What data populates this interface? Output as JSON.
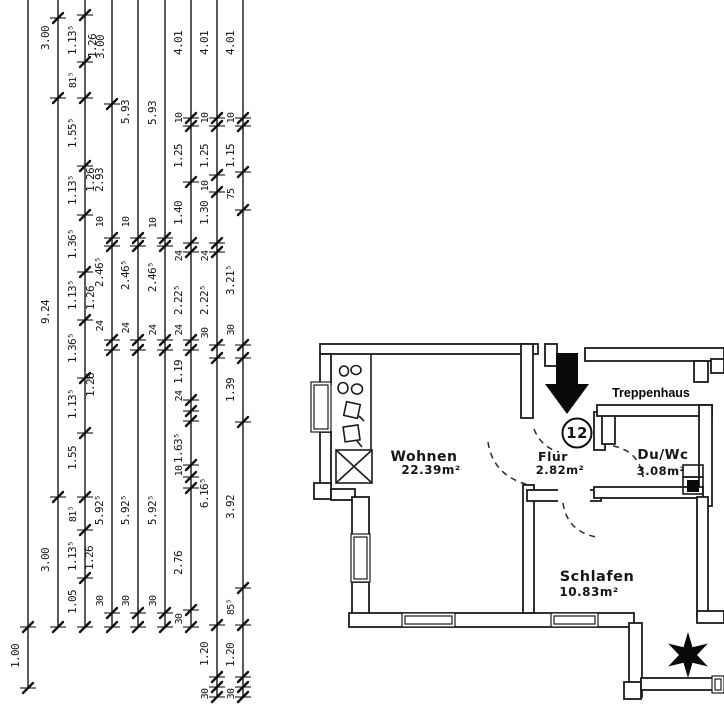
{
  "colors": {
    "ink": "#1b1b1b",
    "paper": "#ffffff"
  },
  "dimension_block": {
    "chains": [
      {
        "x": 28,
        "y1": 0,
        "y2": 688,
        "ticks": [
          627,
          688
        ],
        "labels": [
          {
            "t": "1.00",
            "y": 656
          }
        ]
      },
      {
        "x": 58,
        "y1": 0,
        "y2": 627,
        "ticks": [
          18,
          98,
          497,
          627
        ],
        "labels": [
          {
            "t": "3.00",
            "y": 38
          },
          {
            "t": "9.24",
            "y": 312
          },
          {
            "t": "3.00",
            "y": 560
          }
        ]
      },
      {
        "x": 85,
        "y1": 0,
        "y2": 627,
        "ticks": [
          15,
          62,
          98,
          166,
          215,
          272,
          320,
          378,
          433,
          497,
          530,
          578,
          627
        ],
        "labels": [
          {
            "t": "1.13⁵",
            "y": 40
          },
          {
            "t": "81⁵",
            "y": 80
          },
          {
            "t": "1.55⁵",
            "y": 133
          },
          {
            "t": "1.13⁵",
            "y": 190
          },
          {
            "t": "1.36⁵",
            "y": 244
          },
          {
            "t": "1.13⁵",
            "y": 295
          },
          {
            "t": "1.36⁵",
            "y": 348
          },
          {
            "t": "1.13⁵",
            "y": 404
          },
          {
            "t": "1.55",
            "y": 458
          },
          {
            "t": "81⁵",
            "y": 514
          },
          {
            "t": "1.13⁵",
            "y": 556
          },
          {
            "t": "1.05",
            "y": 602
          }
        ]
      },
      {
        "x": 112,
        "y1": 0,
        "y2": 627,
        "ticks": [
          104,
          238,
          246,
          340,
          350,
          613,
          627
        ],
        "labels": [
          {
            "t": "2.93",
            "y": 180
          },
          {
            "t": "10",
            "y": 222
          },
          {
            "t": "2.46⁵",
            "y": 272
          },
          {
            "t": "24",
            "y": 326
          },
          {
            "t": "5.92⁵",
            "y": 510
          },
          {
            "t": "30",
            "y": 601
          }
        ]
      },
      {
        "x": 138,
        "y1": 0,
        "y2": 627,
        "ticks": [
          238,
          246,
          340,
          350,
          613,
          627
        ],
        "labels": [
          {
            "t": "5.93",
            "y": 112
          },
          {
            "t": "10",
            "y": 222
          },
          {
            "t": "2.46⁵",
            "y": 275
          },
          {
            "t": "24",
            "y": 328
          },
          {
            "t": "5.92⁵",
            "y": 510
          },
          {
            "t": "30",
            "y": 601
          }
        ]
      },
      {
        "x": 165,
        "y1": 0,
        "y2": 627,
        "ticks": [
          238,
          246,
          340,
          350,
          613,
          627
        ],
        "labels": [
          {
            "t": "5.93",
            "y": 113
          },
          {
            "t": "10",
            "y": 223
          },
          {
            "t": "2.46⁵",
            "y": 277
          },
          {
            "t": "24",
            "y": 330
          },
          {
            "t": "5.92⁵",
            "y": 510
          },
          {
            "t": "30",
            "y": 601
          }
        ]
      },
      {
        "x": 191,
        "y1": 0,
        "y2": 627,
        "ticks": [
          118,
          126,
          182,
          243,
          252,
          340,
          350,
          400,
          411,
          421,
          465,
          477,
          488,
          610,
          627
        ],
        "labels": [
          {
            "t": "4.01",
            "y": 43
          },
          {
            "t": "10",
            "y": 118
          },
          {
            "t": "1.25",
            "y": 156
          },
          {
            "t": "1.40",
            "y": 213
          },
          {
            "t": "24",
            "y": 256
          },
          {
            "t": "2.22⁵",
            "y": 300
          },
          {
            "t": "24",
            "y": 330
          },
          {
            "t": "1.19",
            "y": 372
          },
          {
            "t": "24",
            "y": 396
          },
          {
            "t": "1.63⁵",
            "y": 448
          },
          {
            "t": "10",
            "y": 471
          },
          {
            "t": "2.76",
            "y": 563
          },
          {
            "t": "30",
            "y": 619
          }
        ]
      },
      {
        "x": 217,
        "y1": 0,
        "y2": 697,
        "ticks": [
          118,
          126,
          175,
          192,
          243,
          252,
          345,
          358,
          625,
          677,
          687,
          697
        ],
        "labels": [
          {
            "t": "4.01",
            "y": 43
          },
          {
            "t": "10",
            "y": 118
          },
          {
            "t": "1.25",
            "y": 156
          },
          {
            "t": "10",
            "y": 186
          },
          {
            "t": "1.30",
            "y": 213
          },
          {
            "t": "24",
            "y": 256
          },
          {
            "t": "2.22⁵",
            "y": 300
          },
          {
            "t": "30",
            "y": 333
          },
          {
            "t": "6.16⁵",
            "y": 493
          },
          {
            "t": "1.20",
            "y": 654
          },
          {
            "t": "30",
            "y": 694
          }
        ]
      },
      {
        "x": 243,
        "y1": 0,
        "y2": 697,
        "ticks": [
          118,
          126,
          172,
          210,
          345,
          358,
          422,
          588,
          625,
          677,
          687,
          697
        ],
        "labels": [
          {
            "t": "4.01",
            "y": 43
          },
          {
            "t": "10",
            "y": 118
          },
          {
            "t": "1.15",
            "y": 156
          },
          {
            "t": "75",
            "y": 194
          },
          {
            "t": "3.21⁵",
            "y": 280
          },
          {
            "t": "30",
            "y": 330
          },
          {
            "t": "1.39",
            "y": 390
          },
          {
            "t": "3.92",
            "y": 507
          },
          {
            "t": "85⁵",
            "y": 607
          },
          {
            "t": "1.20",
            "y": 655
          },
          {
            "t": "30",
            "y": 694
          }
        ]
      }
    ],
    "free_labels": [
      {
        "t": "1.26",
        "x": 96,
        "y": 46
      },
      {
        "t": "3.00",
        "x": 104,
        "y": 47
      },
      {
        "t": "1.26",
        "x": 94,
        "y": 180
      },
      {
        "t": "1.26",
        "x": 94,
        "y": 298
      },
      {
        "t": "1.26",
        "x": 94,
        "y": 385
      },
      {
        "t": "1.26",
        "x": 93,
        "y": 558
      }
    ]
  },
  "floor_plan": {
    "rooms": [
      {
        "name": "Wohnen",
        "area": "22.39m²"
      },
      {
        "name": "Flur",
        "area": "2.82m²"
      },
      {
        "name": "Du/Wc",
        "area": "3.08m²"
      },
      {
        "name": "Schlafen",
        "area": "10.83m²"
      }
    ],
    "staircase_label": "Treppenhaus",
    "unit_number": "12"
  }
}
